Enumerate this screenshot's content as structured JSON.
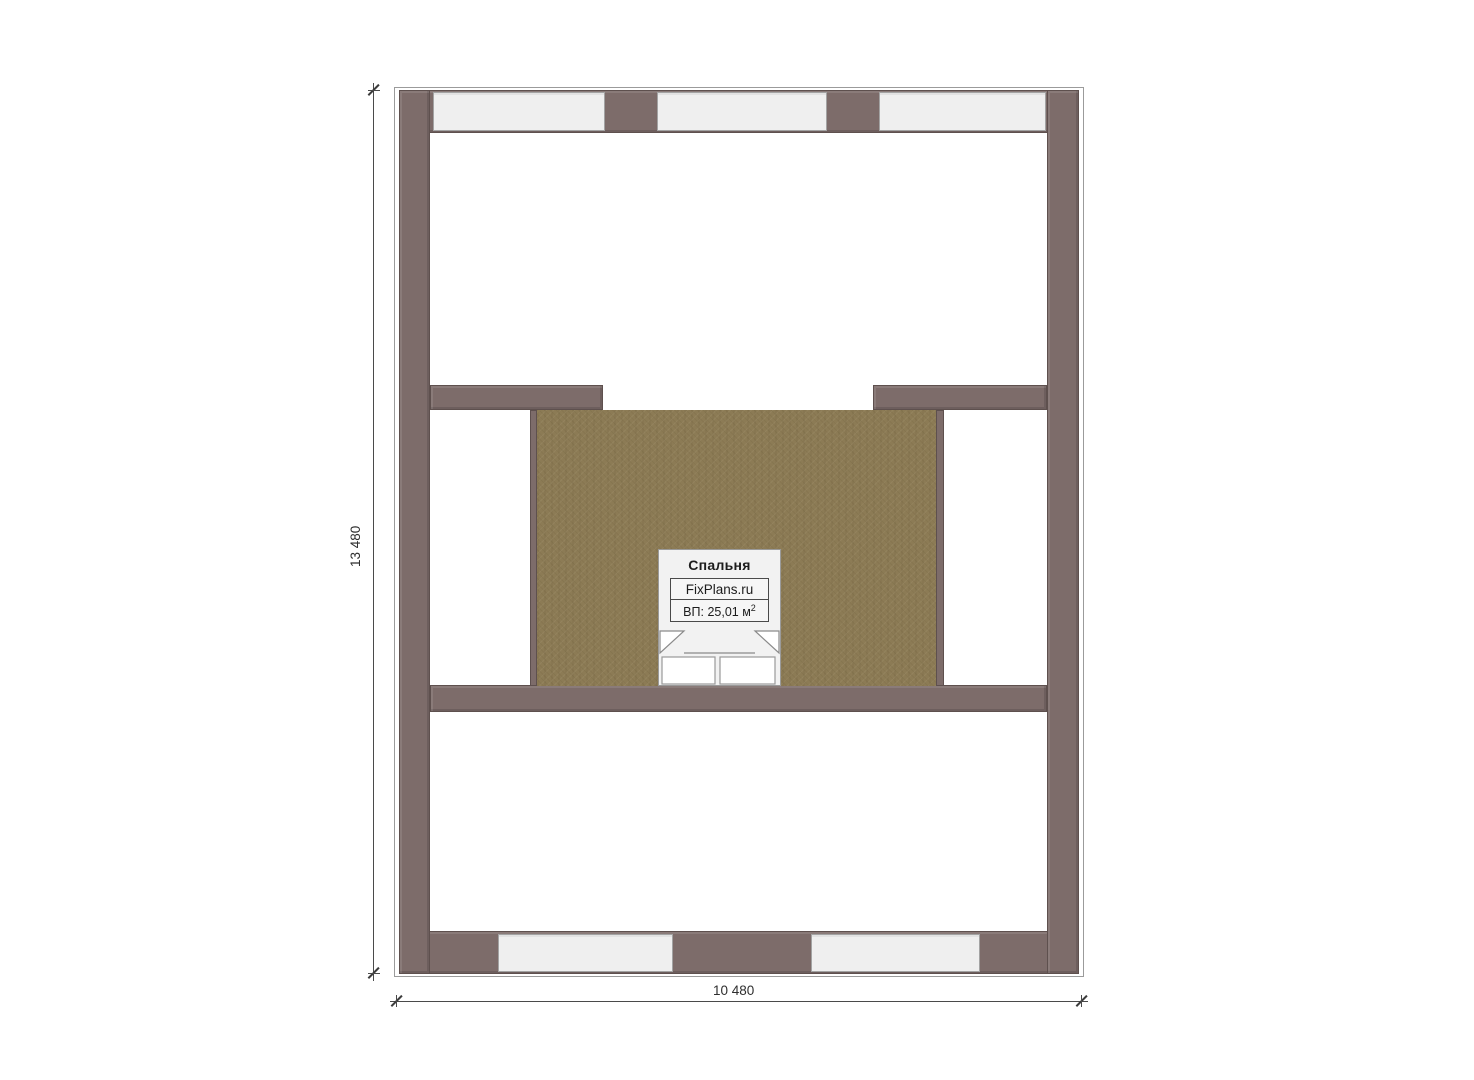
{
  "plan": {
    "room": {
      "name": "Спальня",
      "brand": "FixPlans.ru",
      "area_text": "ВП: 25,01 м",
      "area_sup": "2"
    },
    "dimensions": {
      "height_label": "13 480",
      "width_label": "10 480"
    },
    "colors": {
      "wall": "#7d6c6a",
      "wall_border": "#5e504e",
      "floor": "#8c7b55",
      "window": "#efefef",
      "dim_line": "#4a4a4a"
    }
  }
}
